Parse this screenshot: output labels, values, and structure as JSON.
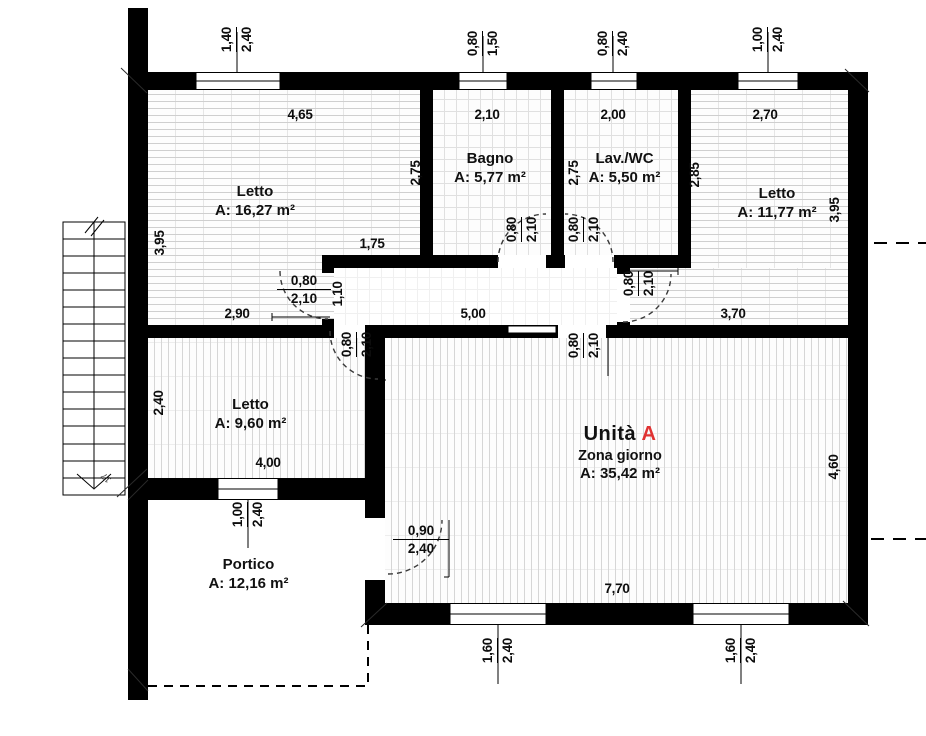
{
  "unit": {
    "word": "Unità",
    "letter": "A",
    "accent_color": "#e03232"
  },
  "rooms": [
    {
      "name": "Letto",
      "area": "A: 16,27 m²"
    },
    {
      "name": "Bagno",
      "area": "A: 5,77 m²"
    },
    {
      "name": "Lav./WC",
      "area": "A: 5,50 m²"
    },
    {
      "name": "Letto",
      "area": "A: 11,77 m²"
    },
    {
      "name": "Letto",
      "area": "A: 9,60 m²"
    },
    {
      "name": "Zona giorno",
      "area": "A: 35,42 m²"
    },
    {
      "name": "Portico",
      "area": "A: 12,16 m²"
    }
  ],
  "dims": {
    "h": [
      "4,65",
      "2,10",
      "2,00",
      "2,70",
      "1,75",
      "2,90",
      "5,00",
      "3,70",
      "4,00",
      "7,70"
    ],
    "v": [
      "3,95",
      "2,75",
      "2,75",
      "2,85",
      "3,95",
      "2,40",
      "4,60",
      "1,10"
    ]
  },
  "windows": [
    {
      "w": "1,40",
      "h": "2,40"
    },
    {
      "w": "0,80",
      "h": "1,50"
    },
    {
      "w": "0,80",
      "h": "2,40"
    },
    {
      "w": "1,00",
      "h": "2,40"
    },
    {
      "w": "1,00",
      "h": "2,40"
    },
    {
      "w": "1,60",
      "h": "2,40"
    },
    {
      "w": "1,60",
      "h": "2,40"
    }
  ],
  "doors": [
    {
      "w": "0,80",
      "h": "2,10"
    },
    {
      "w": "0,80",
      "h": "2,10"
    },
    {
      "w": "0,80",
      "h": "2,10"
    },
    {
      "w": "0,80",
      "h": "2,10"
    },
    {
      "w": "0,80",
      "h": "2,10"
    },
    {
      "w": "0,80",
      "h": "2,10"
    },
    {
      "w": "0,90",
      "h": "2,40"
    }
  ],
  "stairs": {
    "steps_label": "17"
  }
}
